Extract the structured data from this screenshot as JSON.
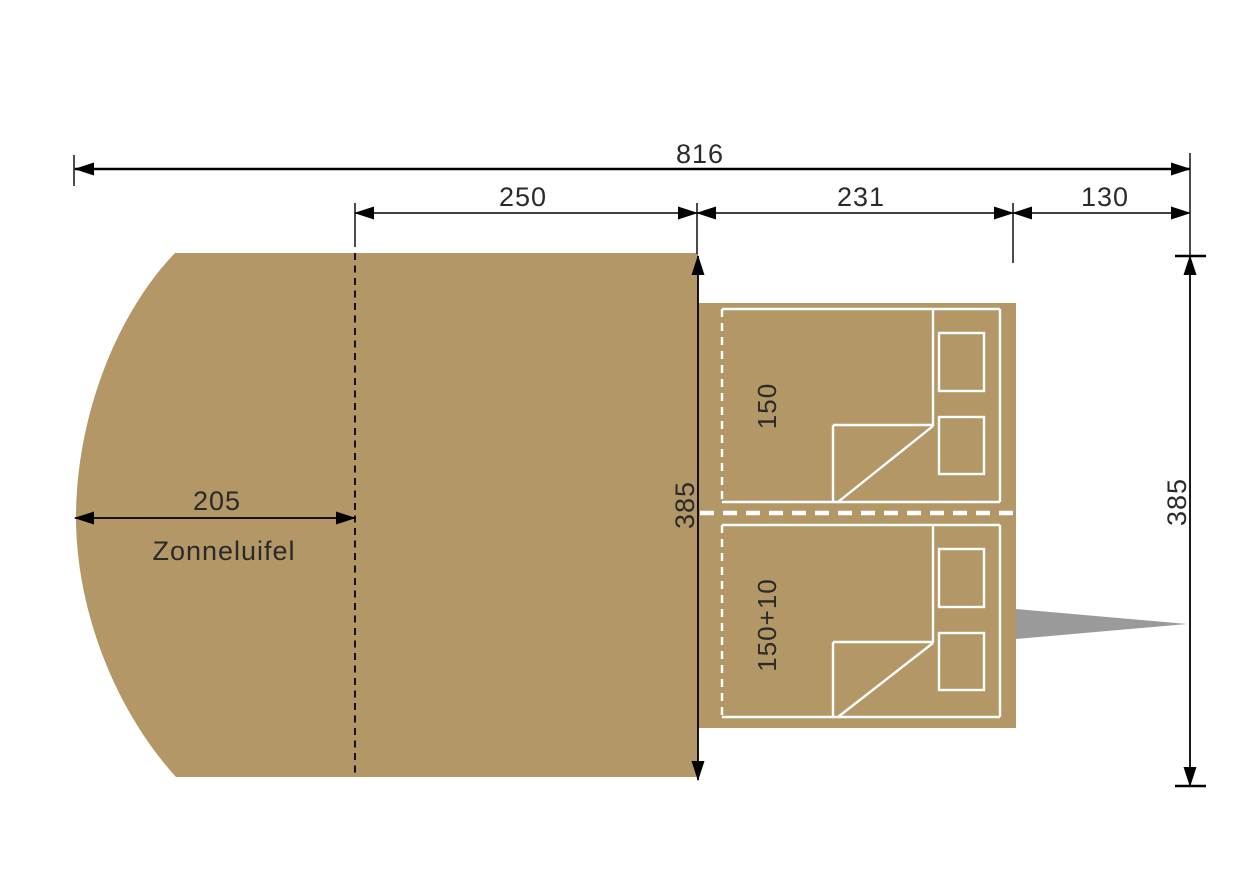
{
  "diagram_type": "trailer-tent-floorplan",
  "colors": {
    "body_fill": "#b49767",
    "drawbar_fill": "#9a9a9a",
    "dimension_line": "#000000",
    "bed_outline": "#ffffff",
    "label_text": "#2a2a2a",
    "background": "#ffffff"
  },
  "dims": {
    "total_length": "816",
    "tent_section": "250",
    "trailer_body": "231",
    "drawbar": "130",
    "awning_projection": "205",
    "awning_label": "Zonneluifel",
    "depth_left": "385",
    "depth_right": "385"
  },
  "beds": [
    {
      "label": "150"
    },
    {
      "label": "150+10"
    }
  ]
}
